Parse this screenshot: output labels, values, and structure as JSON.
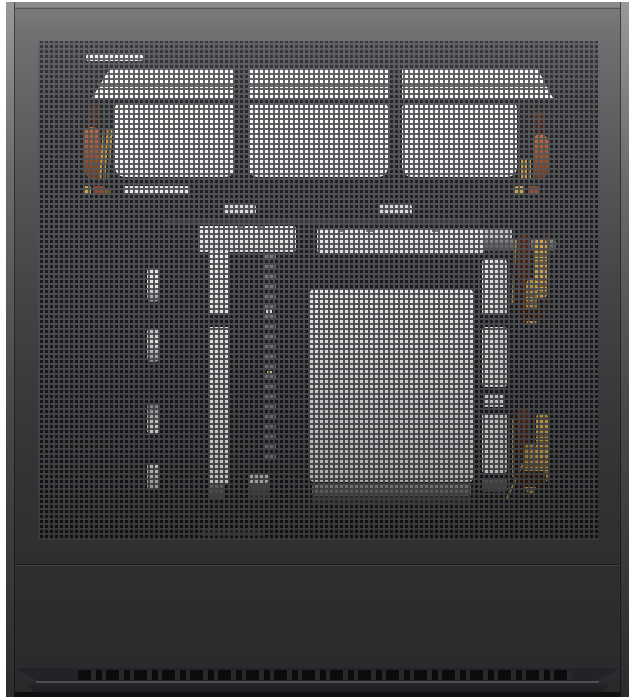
{
  "scene": {
    "subject": "computer-case-mesh-side-panel-product-photo",
    "view": "straight-on exterior view, black PC case with full perforated mesh panel revealing white internal components and orange cables",
    "background": "#ffffff",
    "palette": {
      "case_top_gray": "#717274",
      "case_mid_gray": "#454648",
      "case_bottom_gray": "#2b2b2d",
      "mesh_grid_gray": "#525356",
      "interior_black": "#1c1c1e",
      "component_white": "#f5f5f6",
      "cable_orange": "#b35c2c",
      "cable_gold": "#c99c45",
      "cable_brown": "#53251a"
    },
    "counts": {
      "top_fan_shrouds": 3,
      "top_vent_segments": 9,
      "mid_vent_segments": 7,
      "left_grommet_slots": 4,
      "right_strap_rectangles": 3,
      "cable_clusters": 4,
      "bottom_vent_band": 1
    }
  }
}
